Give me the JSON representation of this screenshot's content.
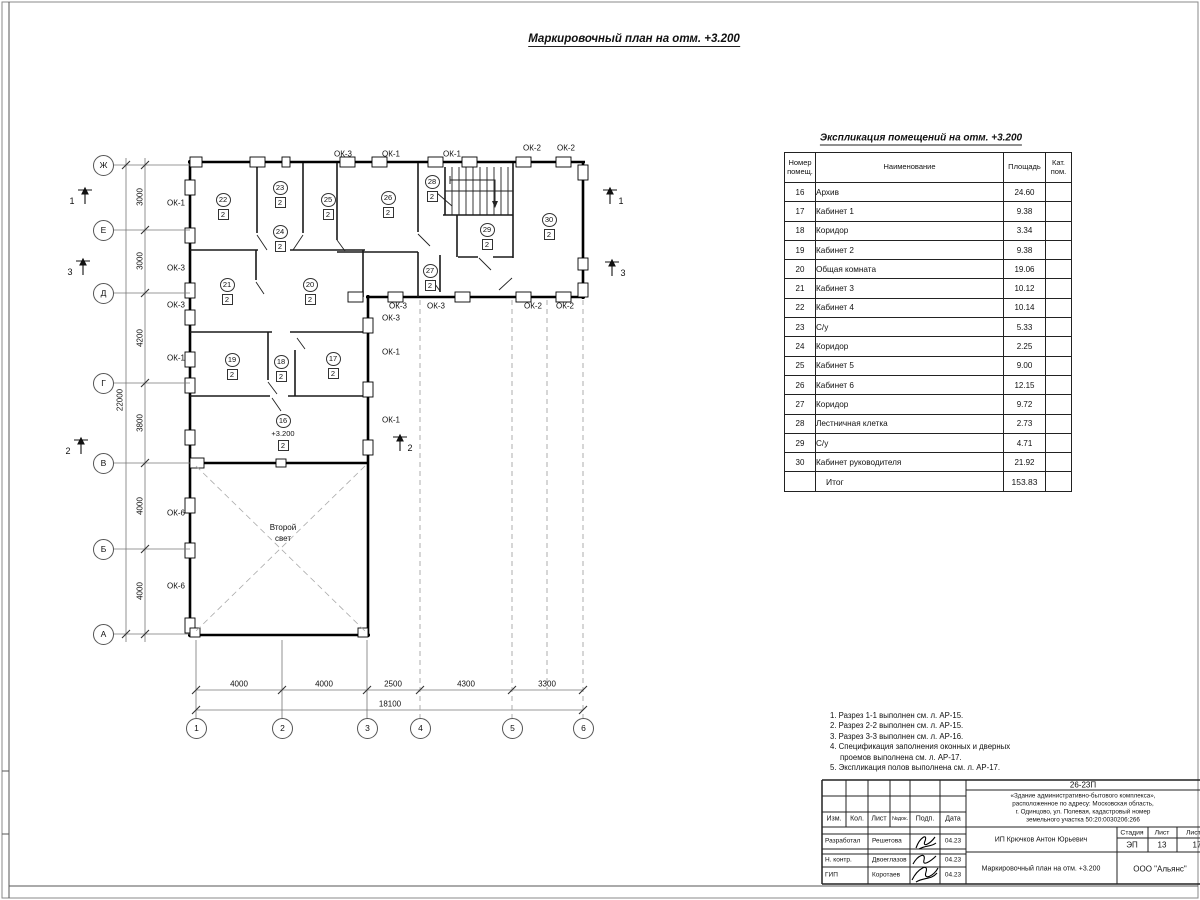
{
  "plan_title": "Маркировочный план на отм. +3.200",
  "schedule": {
    "title": "Экспликация помещений на отм. +3.200",
    "col_num": "Номер помещ.",
    "col_name": "Наименование",
    "col_area": "Площадь",
    "col_cat": "Кат. пом.",
    "rows": [
      {
        "num": "16",
        "name": "Архив",
        "area": "24.60"
      },
      {
        "num": "17",
        "name": "Кабинет 1",
        "area": "9.38"
      },
      {
        "num": "18",
        "name": "Коридор",
        "area": "3.34"
      },
      {
        "num": "19",
        "name": "Кабинет 2",
        "area": "9.38"
      },
      {
        "num": "20",
        "name": "Общая комната",
        "area": "19.06"
      },
      {
        "num": "21",
        "name": "Кабинет 3",
        "area": "10.12"
      },
      {
        "num": "22",
        "name": "Кабинет 4",
        "area": "10.14"
      },
      {
        "num": "23",
        "name": "С/у",
        "area": "5.33"
      },
      {
        "num": "24",
        "name": "Коридор",
        "area": "2.25"
      },
      {
        "num": "25",
        "name": "Кабинет 5",
        "area": "9.00"
      },
      {
        "num": "26",
        "name": "Кабинет 6",
        "area": "12.15"
      },
      {
        "num": "27",
        "name": "Коридор",
        "area": "9.72"
      },
      {
        "num": "28",
        "name": "Лестничная клетка",
        "area": "2.73"
      },
      {
        "num": "29",
        "name": "С/у",
        "area": "4.71"
      },
      {
        "num": "30",
        "name": "Кабинет руководителя",
        "area": "21.92"
      }
    ],
    "total_label": "Итог",
    "total_area": "153.83"
  },
  "plan": {
    "rooms": [
      {
        "id": "22",
        "floor": "2"
      },
      {
        "id": "23",
        "floor": "2"
      },
      {
        "id": "24",
        "floor": "2"
      },
      {
        "id": "25",
        "floor": "2"
      },
      {
        "id": "26",
        "floor": "2"
      },
      {
        "id": "28",
        "floor": "2"
      },
      {
        "id": "29",
        "floor": "2"
      },
      {
        "id": "30",
        "floor": "2"
      },
      {
        "id": "21",
        "floor": "2"
      },
      {
        "id": "20",
        "floor": "2"
      },
      {
        "id": "27",
        "floor": "2"
      },
      {
        "id": "19",
        "floor": "2"
      },
      {
        "id": "18",
        "floor": "2"
      },
      {
        "id": "17",
        "floor": "2"
      },
      {
        "id": "16",
        "floor": "2"
      }
    ],
    "room16_level": "+3.200",
    "second_light_line1": "Второй",
    "second_light_line2": "свет",
    "win_left": [
      "ОК-1",
      "ОК-3",
      "ОК-3",
      "ОК-1",
      "ОК-6",
      "ОК-6"
    ],
    "win_top": [
      "ОК-3",
      "ОК-1",
      "ОК-1",
      "ОК-2",
      "ОК-2"
    ],
    "win_bottom": [
      "ОК-3",
      "ОК-3",
      "ОК-2",
      "ОК-2"
    ],
    "win_right": [
      "ОК-3",
      "ОК-1",
      "ОК-1"
    ],
    "axis_letters": [
      "Ж",
      "Е",
      "Д",
      "Г",
      "В",
      "Б",
      "А"
    ],
    "axis_numbers": [
      "1",
      "2",
      "3",
      "4",
      "5",
      "6"
    ],
    "dims_v": [
      "3000",
      "3000",
      "4200",
      "3800",
      "4000",
      "4000"
    ],
    "dim_v_total": "22000",
    "dims_h": [
      "4000",
      "4000",
      "2500",
      "4300",
      "3300"
    ],
    "dim_h_total": "18100",
    "sections": {
      "s1": "1",
      "s2": "2",
      "s3": "3"
    }
  },
  "notes": {
    "lines": [
      "1. Разрез 1-1 выполнен см. л. АР-15.",
      "2. Разрез 2-2 выполнен см. л. АР-15.",
      "3. Разрез 3-3 выполнен см. л. АР-16.",
      "4. Спецификация заполнения оконных и дверных",
      "проемов выполнена см. л. АР-17.",
      "5. Экспликация полов выполнена см. л. АР-17."
    ]
  },
  "tb": {
    "code": "26-23П",
    "desc1": "«Здание административно-бытового комплекса»,",
    "desc2": "расположенное по адресу: Московская область,",
    "desc3": "г. Одинцово, ул. Полевая, кадастровый номер",
    "desc4": "земельного участка 50:20:0030206:266",
    "col_izm": "Изм.",
    "col_kol": "Кол.",
    "col_list": "Лист",
    "col_ndok": "№док.",
    "col_podp": "Подп.",
    "col_data": "Дата",
    "r1_role": "Разработал",
    "r1_name": "Решетова",
    "r1_date": "04.23",
    "r2_role": "Н. контр.",
    "r2_name": "Двоеглазов",
    "r2_date": "04.23",
    "r3_role": "ГИП",
    "r3_name": "Коротаев",
    "r3_date": "04.23",
    "client": "ИП Крючков Антон Юрьевич",
    "stage_label": "Стадия",
    "sheet_label": "Лист",
    "sheets_label": "Листов",
    "stage": "ЭП",
    "sheet": "13",
    "sheets": "17",
    "doc_title": "Маркировочный план на отм. +3.200",
    "company": "ООО \"Альянс\""
  }
}
